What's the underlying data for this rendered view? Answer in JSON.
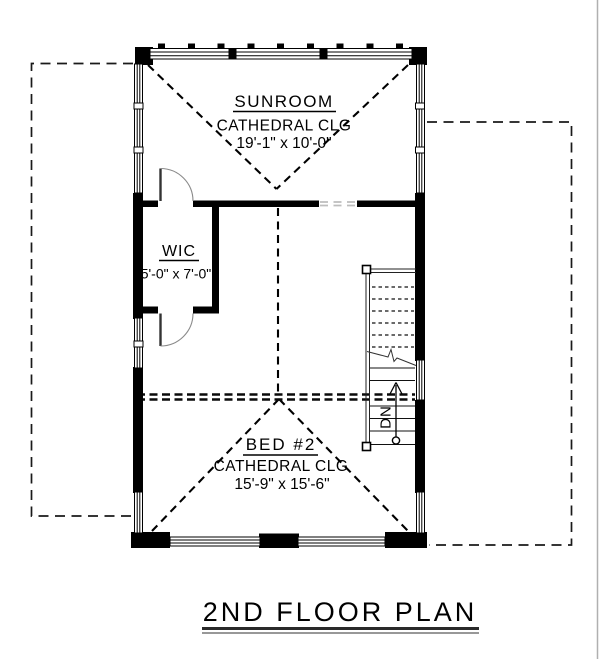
{
  "page": {
    "title_label": "2ND FLOOR PLAN"
  },
  "rooms": {
    "sunroom": {
      "name": "SUNROOM",
      "ceiling": "CATHEDRAL CLG",
      "dims": "19'-1\" x 10'-0\""
    },
    "wic": {
      "name": "WIC",
      "dims": "5'-0\" x 7'-0\""
    },
    "bed2": {
      "name": "BED #2",
      "ceiling": "CATHEDRAL CLG",
      "dims": "15'-9\" x 15'-6\""
    }
  },
  "stairs": {
    "direction_label": "DN"
  },
  "colors": {
    "line": "#000000",
    "door_arc": "#8a8a8a",
    "opening_dash": "#bdbdbd",
    "page_border": "#b0b0b0",
    "title_underline_top": "#2a2a2a",
    "title_underline_bottom": "#777777"
  }
}
